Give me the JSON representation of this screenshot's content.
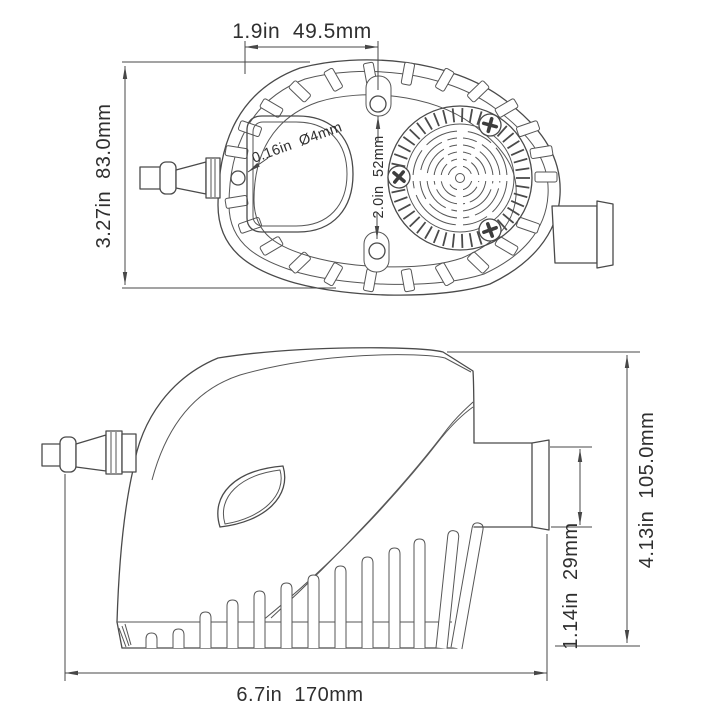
{
  "drawing": {
    "background": "#ffffff",
    "line_color": "#4a4a4a",
    "text_color": "#2f2f2f",
    "top_view": {
      "dim_width": "1.9in  49.5mm",
      "dim_height": "3.27in  83.0mm",
      "dim_pilot_hole": "0.16in  Ø4mm",
      "dim_hole_spacing": "2.0in  52mm"
    },
    "side_view": {
      "dim_height": "4.13in  105.0mm",
      "dim_outlet": "1.14in  29mm",
      "dim_length": "6.7in  170mm"
    }
  }
}
